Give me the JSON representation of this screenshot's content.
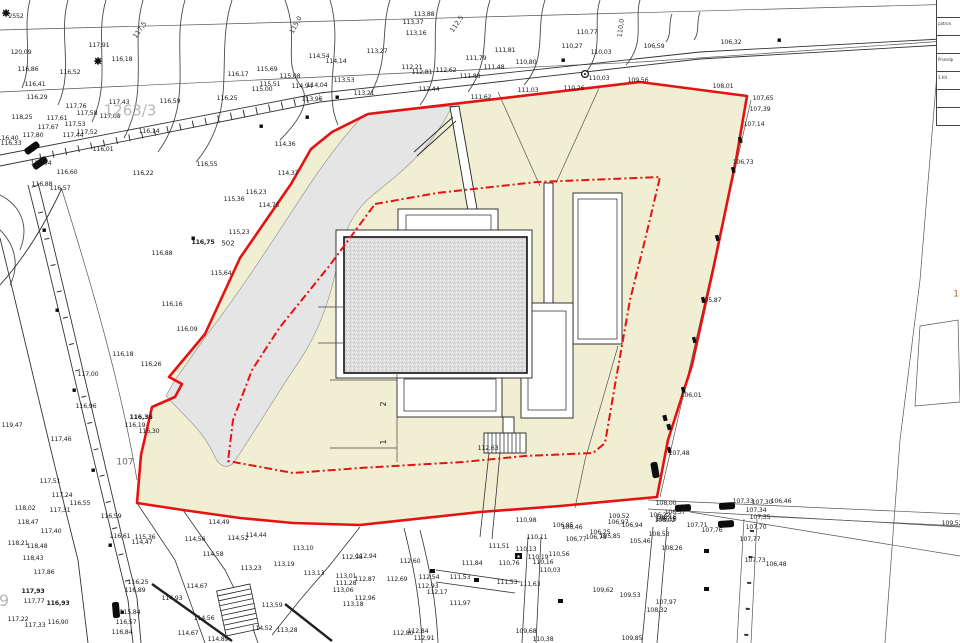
{
  "canvas": {
    "width": 960,
    "height": 643
  },
  "colors": {
    "site_fill": "#f0eed3",
    "boundary_red": "#e61212",
    "driveway_gray": "#e5e5e5",
    "hatch_gray": "#dadada",
    "line_dark": "#2a2a2a",
    "line_gray": "#909090",
    "parcel_text": "#b8b8b8",
    "orange_text": "#b5651d"
  },
  "legend_panel": {
    "rows": [
      "",
      "patron",
      "",
      "Priandp",
      "1.hit",
      "",
      ""
    ]
  },
  "parcel_labels": [
    {
      "t": "1263/3",
      "x": 130,
      "y": 111,
      "s": 15
    },
    {
      "t": "107",
      "x": 125,
      "y": 463,
      "s": 9,
      "c": "#666"
    },
    {
      "t": "502",
      "x": 228,
      "y": 244,
      "s": 7,
      "c": "#222",
      "b": 1
    },
    {
      "t": "9",
      "x": 4,
      "y": 601,
      "s": 16
    }
  ],
  "contour_labels": [
    {
      "t": "117,5",
      "x": 140,
      "y": 30,
      "r": -55
    },
    {
      "t": "115,0",
      "x": 296,
      "y": 25,
      "r": -62
    },
    {
      "t": "112,5",
      "x": 457,
      "y": 24,
      "r": -55
    },
    {
      "t": "110,0",
      "x": 621,
      "y": 28,
      "r": -83
    }
  ],
  "parking_numbers": [
    {
      "t": "2",
      "x": 384,
      "y": 404
    },
    {
      "t": "1",
      "x": 384,
      "y": 442
    }
  ],
  "elevation_labels": [
    {
      "t": "2552",
      "x": 16,
      "y": 17
    },
    {
      "t": "120,09",
      "x": 21,
      "y": 53
    },
    {
      "t": "116,86",
      "x": 28,
      "y": 70
    },
    {
      "t": "116,52",
      "x": 70,
      "y": 73
    },
    {
      "t": "116,41",
      "x": 35,
      "y": 85
    },
    {
      "t": "116,29",
      "x": 37,
      "y": 98
    },
    {
      "t": "117,91",
      "x": 99,
      "y": 46
    },
    {
      "t": "116,18",
      "x": 122,
      "y": 60
    },
    {
      "t": "117,76",
      "x": 76,
      "y": 107
    },
    {
      "t": "117,43",
      "x": 119,
      "y": 103
    },
    {
      "t": "117,58",
      "x": 87,
      "y": 114
    },
    {
      "t": "117,08",
      "x": 110,
      "y": 117
    },
    {
      "t": "118,25",
      "x": 22,
      "y": 118
    },
    {
      "t": "117,61",
      "x": 57,
      "y": 119
    },
    {
      "t": "117,67",
      "x": 48,
      "y": 128
    },
    {
      "t": "117,53",
      "x": 75,
      "y": 125
    },
    {
      "t": "117,44",
      "x": 73,
      "y": 136
    },
    {
      "t": "117,52",
      "x": 87,
      "y": 133
    },
    {
      "t": "117,80",
      "x": 33,
      "y": 136
    },
    {
      "t": "116,40",
      "x": 8,
      "y": 139
    },
    {
      "t": "116,33",
      "x": 11,
      "y": 144
    },
    {
      "t": "117,94",
      "x": 41,
      "y": 164
    },
    {
      "t": "116,60",
      "x": 67,
      "y": 173
    },
    {
      "t": "116,88",
      "x": 42,
      "y": 185
    },
    {
      "t": "116,57",
      "x": 60,
      "y": 189
    },
    {
      "t": "116,59",
      "x": 170,
      "y": 102
    },
    {
      "t": "116,25",
      "x": 227,
      "y": 99
    },
    {
      "t": "116,17",
      "x": 238,
      "y": 75
    },
    {
      "t": "115,69",
      "x": 267,
      "y": 70
    },
    {
      "t": "115,51",
      "x": 270,
      "y": 85
    },
    {
      "t": "115,00",
      "x": 262,
      "y": 90
    },
    {
      "t": "115,08",
      "x": 290,
      "y": 77
    },
    {
      "t": "114,94",
      "x": 302,
      "y": 87
    },
    {
      "t": "113,96",
      "x": 312,
      "y": 100
    },
    {
      "t": "116,14",
      "x": 149,
      "y": 132
    },
    {
      "t": "116,01",
      "x": 103,
      "y": 150
    },
    {
      "t": "116,55",
      "x": 207,
      "y": 165
    },
    {
      "t": "116,22",
      "x": 143,
      "y": 174
    },
    {
      "t": "114,36",
      "x": 285,
      "y": 145
    },
    {
      "t": "114,37",
      "x": 288,
      "y": 174
    },
    {
      "t": "116,23",
      "x": 256,
      "y": 193
    },
    {
      "t": "113,27",
      "x": 377,
      "y": 52
    },
    {
      "t": "113,88",
      "x": 424,
      "y": 15
    },
    {
      "t": "113,37",
      "x": 413,
      "y": 23
    },
    {
      "t": "113,16",
      "x": 416,
      "y": 34
    },
    {
      "t": "114,54",
      "x": 319,
      "y": 57
    },
    {
      "t": "114,14",
      "x": 336,
      "y": 62
    },
    {
      "t": "113,53",
      "x": 344,
      "y": 81
    },
    {
      "t": "114,04",
      "x": 317,
      "y": 86
    },
    {
      "t": "113,21",
      "x": 364,
      "y": 94
    },
    {
      "t": "112,21",
      "x": 412,
      "y": 68
    },
    {
      "t": "112,81",
      "x": 422,
      "y": 73
    },
    {
      "t": "112,62",
      "x": 446,
      "y": 71
    },
    {
      "t": "112,44",
      "x": 429,
      "y": 90
    },
    {
      "t": "111,79",
      "x": 476,
      "y": 59
    },
    {
      "t": "111,48",
      "x": 494,
      "y": 68
    },
    {
      "t": "111,88",
      "x": 470,
      "y": 77
    },
    {
      "t": "111,81",
      "x": 505,
      "y": 51
    },
    {
      "t": "110,80",
      "x": 526,
      "y": 63
    },
    {
      "t": "110,77",
      "x": 587,
      "y": 33
    },
    {
      "t": "110,27",
      "x": 572,
      "y": 47
    },
    {
      "t": "110,03",
      "x": 601,
      "y": 53
    },
    {
      "t": "110,03",
      "x": 599,
      "y": 79
    },
    {
      "t": "110,26",
      "x": 574,
      "y": 89
    },
    {
      "t": "111,03",
      "x": 528,
      "y": 91
    },
    {
      "t": "111,62",
      "x": 481,
      "y": 98
    },
    {
      "t": "109,56",
      "x": 638,
      "y": 81
    },
    {
      "t": "106,59",
      "x": 654,
      "y": 47
    },
    {
      "t": "106,32",
      "x": 731,
      "y": 43
    },
    {
      "t": "108,01",
      "x": 723,
      "y": 87
    },
    {
      "t": "107,65",
      "x": 763,
      "y": 99
    },
    {
      "t": "107,39",
      "x": 760,
      "y": 110
    },
    {
      "t": "107,14",
      "x": 754,
      "y": 125
    },
    {
      "t": "106,73",
      "x": 743,
      "y": 163
    },
    {
      "t": "105,87",
      "x": 711,
      "y": 301
    },
    {
      "t": "106,01",
      "x": 691,
      "y": 396
    },
    {
      "t": "107,48",
      "x": 679,
      "y": 454
    },
    {
      "t": "116,75",
      "x": 203,
      "y": 243,
      "b": 1
    },
    {
      "t": "115,23",
      "x": 239,
      "y": 233
    },
    {
      "t": "114,75",
      "x": 269,
      "y": 206
    },
    {
      "t": "115,36",
      "x": 234,
      "y": 200
    },
    {
      "t": "115,64",
      "x": 221,
      "y": 274
    },
    {
      "t": "116,16",
      "x": 172,
      "y": 305
    },
    {
      "t": "116,09",
      "x": 187,
      "y": 330
    },
    {
      "t": "116,88",
      "x": 162,
      "y": 254
    },
    {
      "t": "117,00",
      "x": 88,
      "y": 375
    },
    {
      "t": "116,96",
      "x": 86,
      "y": 407
    },
    {
      "t": "116,26",
      "x": 151,
      "y": 365
    },
    {
      "t": "116,18",
      "x": 123,
      "y": 355
    },
    {
      "t": "116,36",
      "x": 141,
      "y": 418,
      "b": 1
    },
    {
      "t": "116,19",
      "x": 135,
      "y": 426
    },
    {
      "t": "116,30",
      "x": 149,
      "y": 432
    },
    {
      "t": "116,55",
      "x": 80,
      "y": 504
    },
    {
      "t": "116,59",
      "x": 111,
      "y": 517
    },
    {
      "t": "116,61",
      "x": 120,
      "y": 537
    },
    {
      "t": "115,36",
      "x": 145,
      "y": 538
    },
    {
      "t": "114,47",
      "x": 142,
      "y": 543
    },
    {
      "t": "119,47",
      "x": 12,
      "y": 426
    },
    {
      "t": "117,46",
      "x": 61,
      "y": 440
    },
    {
      "t": "117,51",
      "x": 50,
      "y": 482
    },
    {
      "t": "117,24",
      "x": 62,
      "y": 496
    },
    {
      "t": "117,31",
      "x": 60,
      "y": 511
    },
    {
      "t": "117,40",
      "x": 51,
      "y": 532
    },
    {
      "t": "118,02",
      "x": 25,
      "y": 509
    },
    {
      "t": "118,47",
      "x": 28,
      "y": 523
    },
    {
      "t": "118,21",
      "x": 18,
      "y": 544
    },
    {
      "t": "118,48",
      "x": 37,
      "y": 547
    },
    {
      "t": "118,43",
      "x": 33,
      "y": 559
    },
    {
      "t": "117,86",
      "x": 44,
      "y": 573
    },
    {
      "t": "117,93",
      "x": 33,
      "y": 592,
      "b": 1
    },
    {
      "t": "117,77",
      "x": 34,
      "y": 602
    },
    {
      "t": "116,93",
      "x": 58,
      "y": 604,
      "b": 1
    },
    {
      "t": "117,22",
      "x": 18,
      "y": 620
    },
    {
      "t": "117,33",
      "x": 35,
      "y": 626
    },
    {
      "t": "116,90",
      "x": 58,
      "y": 623
    },
    {
      "t": "116,25",
      "x": 138,
      "y": 583
    },
    {
      "t": "116,89",
      "x": 135,
      "y": 591
    },
    {
      "t": "115,84",
      "x": 130,
      "y": 613
    },
    {
      "t": "116,57",
      "x": 126,
      "y": 623
    },
    {
      "t": "116,84",
      "x": 122,
      "y": 633
    },
    {
      "t": "114,49",
      "x": 219,
      "y": 523
    },
    {
      "t": "114,56",
      "x": 195,
      "y": 540
    },
    {
      "t": "114,44",
      "x": 256,
      "y": 536
    },
    {
      "t": "114,52",
      "x": 238,
      "y": 539
    },
    {
      "t": "113,10",
      "x": 303,
      "y": 549
    },
    {
      "t": "113,19",
      "x": 284,
      "y": 565
    },
    {
      "t": "113,23",
      "x": 251,
      "y": 569
    },
    {
      "t": "114,58",
      "x": 213,
      "y": 555
    },
    {
      "t": "113,13",
      "x": 314,
      "y": 574
    },
    {
      "t": "113,01",
      "x": 346,
      "y": 577
    },
    {
      "t": "112,87",
      "x": 365,
      "y": 580
    },
    {
      "t": "113,06",
      "x": 343,
      "y": 591
    },
    {
      "t": "112,96",
      "x": 365,
      "y": 599
    },
    {
      "t": "113,18",
      "x": 353,
      "y": 605
    },
    {
      "t": "114,67",
      "x": 197,
      "y": 587
    },
    {
      "t": "114,93",
      "x": 172,
      "y": 599
    },
    {
      "t": "114,67",
      "x": 188,
      "y": 634
    },
    {
      "t": "114,56",
      "x": 204,
      "y": 619
    },
    {
      "t": "114,52",
      "x": 262,
      "y": 629
    },
    {
      "t": "113,59",
      "x": 272,
      "y": 606
    },
    {
      "t": "113,28",
      "x": 287,
      "y": 631
    },
    {
      "t": "114,89",
      "x": 218,
      "y": 640
    },
    {
      "t": "112,98",
      "x": 352,
      "y": 558
    },
    {
      "t": "112,94",
      "x": 366,
      "y": 557
    },
    {
      "t": "111,28",
      "x": 346,
      "y": 584
    },
    {
      "t": "112,69",
      "x": 397,
      "y": 580
    },
    {
      "t": "112,84",
      "x": 418,
      "y": 632
    },
    {
      "t": "112,80",
      "x": 403,
      "y": 634
    },
    {
      "t": "112,91",
      "x": 424,
      "y": 639
    },
    {
      "t": "112,63",
      "x": 488,
      "y": 449
    },
    {
      "t": "111,51",
      "x": 499,
      "y": 547
    },
    {
      "t": "110,98",
      "x": 526,
      "y": 521
    },
    {
      "t": "110,11",
      "x": 537,
      "y": 538
    },
    {
      "t": "110,13",
      "x": 526,
      "y": 550
    },
    {
      "t": "110,19",
      "x": 538,
      "y": 558
    },
    {
      "t": "110,16",
      "x": 543,
      "y": 563
    },
    {
      "t": "110,56",
      "x": 559,
      "y": 555
    },
    {
      "t": "110,03",
      "x": 550,
      "y": 571
    },
    {
      "t": "111,84",
      "x": 472,
      "y": 564
    },
    {
      "t": "111,53",
      "x": 460,
      "y": 578
    },
    {
      "t": "111,63",
      "x": 530,
      "y": 585
    },
    {
      "t": "111,97",
      "x": 460,
      "y": 604
    },
    {
      "t": "112,17",
      "x": 437,
      "y": 593
    },
    {
      "t": "112,54",
      "x": 429,
      "y": 578
    },
    {
      "t": "112,60",
      "x": 410,
      "y": 562
    },
    {
      "t": "112,93",
      "x": 428,
      "y": 587
    },
    {
      "t": "110,76",
      "x": 509,
      "y": 564
    },
    {
      "t": "111,53",
      "x": 507,
      "y": 583
    },
    {
      "t": "109,68",
      "x": 526,
      "y": 632
    },
    {
      "t": "110,38",
      "x": 543,
      "y": 640
    },
    {
      "t": "109,85",
      "x": 632,
      "y": 639
    },
    {
      "t": "109,62",
      "x": 603,
      "y": 591
    },
    {
      "t": "109,53",
      "x": 630,
      "y": 596
    },
    {
      "t": "109,52",
      "x": 619,
      "y": 517
    },
    {
      "t": "105,46",
      "x": 640,
      "y": 542
    },
    {
      "t": "106,22",
      "x": 660,
      "y": 516
    },
    {
      "t": "106,16",
      "x": 666,
      "y": 520
    },
    {
      "t": "106,97",
      "x": 618,
      "y": 523
    },
    {
      "t": "106,94",
      "x": 632,
      "y": 526
    },
    {
      "t": "106,95",
      "x": 563,
      "y": 526
    },
    {
      "t": "106,46",
      "x": 572,
      "y": 528
    },
    {
      "t": "106,25",
      "x": 600,
      "y": 533
    },
    {
      "t": "106,78",
      "x": 596,
      "y": 538
    },
    {
      "t": "106,77",
      "x": 576,
      "y": 540
    },
    {
      "t": "105,85",
      "x": 610,
      "y": 537
    },
    {
      "t": "108,00",
      "x": 666,
      "y": 504
    },
    {
      "t": "106,37",
      "x": 675,
      "y": 513
    },
    {
      "t": "108,16",
      "x": 666,
      "y": 518
    },
    {
      "t": "108,02",
      "x": 665,
      "y": 521
    },
    {
      "t": "108,53",
      "x": 659,
      "y": 535
    },
    {
      "t": "108,26",
      "x": 672,
      "y": 549
    },
    {
      "t": "107,97",
      "x": 666,
      "y": 603
    },
    {
      "t": "108,32",
      "x": 657,
      "y": 611
    },
    {
      "t": "107,71",
      "x": 697,
      "y": 526
    },
    {
      "t": "107,76",
      "x": 712,
      "y": 531
    },
    {
      "t": "107,33",
      "x": 743,
      "y": 502
    },
    {
      "t": "107,30",
      "x": 762,
      "y": 503
    },
    {
      "t": "106,46",
      "x": 781,
      "y": 502
    },
    {
      "t": "107,34",
      "x": 756,
      "y": 511
    },
    {
      "t": "107,35",
      "x": 760,
      "y": 518
    },
    {
      "t": "107,70",
      "x": 756,
      "y": 528
    },
    {
      "t": "107,77",
      "x": 750,
      "y": 540
    },
    {
      "t": "107,73",
      "x": 755,
      "y": 561
    },
    {
      "t": "106,48",
      "x": 776,
      "y": 565
    },
    {
      "t": "109,52",
      "x": 952,
      "y": 524
    },
    {
      "t": "1",
      "x": 956,
      "y": 295,
      "c": "#b5651d",
      "s": 9
    }
  ]
}
